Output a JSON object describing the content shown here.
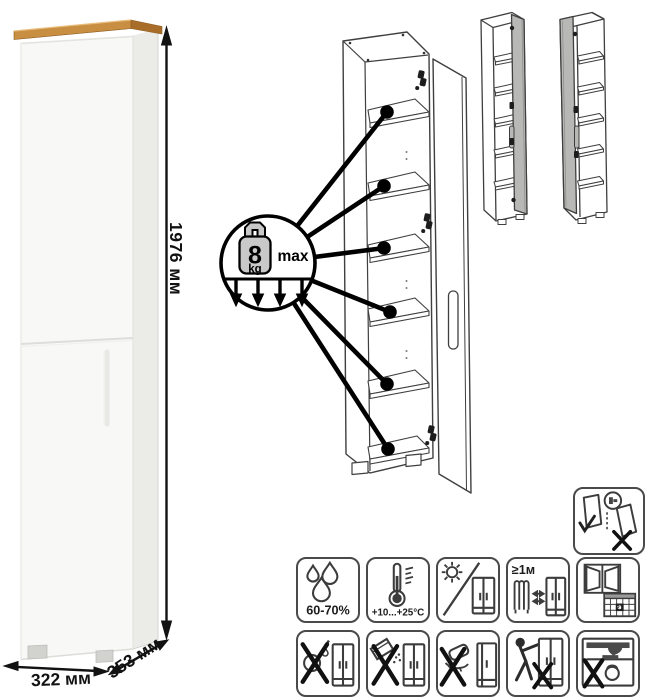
{
  "dimensions": {
    "height": "1976 мм",
    "width": "322 мм",
    "depth": "353 мм"
  },
  "callout": {
    "weight": "8",
    "unit": "kg",
    "max_label": "max",
    "shelf_count": 6
  },
  "care": {
    "humidity_label": "60-70%",
    "temperature_label": "+10...+25°C",
    "distance_label": "≥1м",
    "calendar_day": "21"
  },
  "icons": {
    "anti_tip": "secure-to-wall-icon",
    "row1": [
      "humidity-icon",
      "temperature-icon",
      "no-direct-sunlight-icon",
      "heat-distance-icon",
      "ventilation-icon"
    ],
    "row2": [
      "no-wet-cleaning-icon",
      "no-abrasive-powder-icon",
      "no-scrubbing-icon",
      "no-dragging-icon",
      "no-overload-icon"
    ]
  },
  "colors": {
    "wood_top": "#c88e41",
    "cabinet_front": "#f8f8f6",
    "cabinet_side": "#ebebe8",
    "door_variant_gray": "#b8b8b6",
    "line_art": "#3f3f3f"
  }
}
